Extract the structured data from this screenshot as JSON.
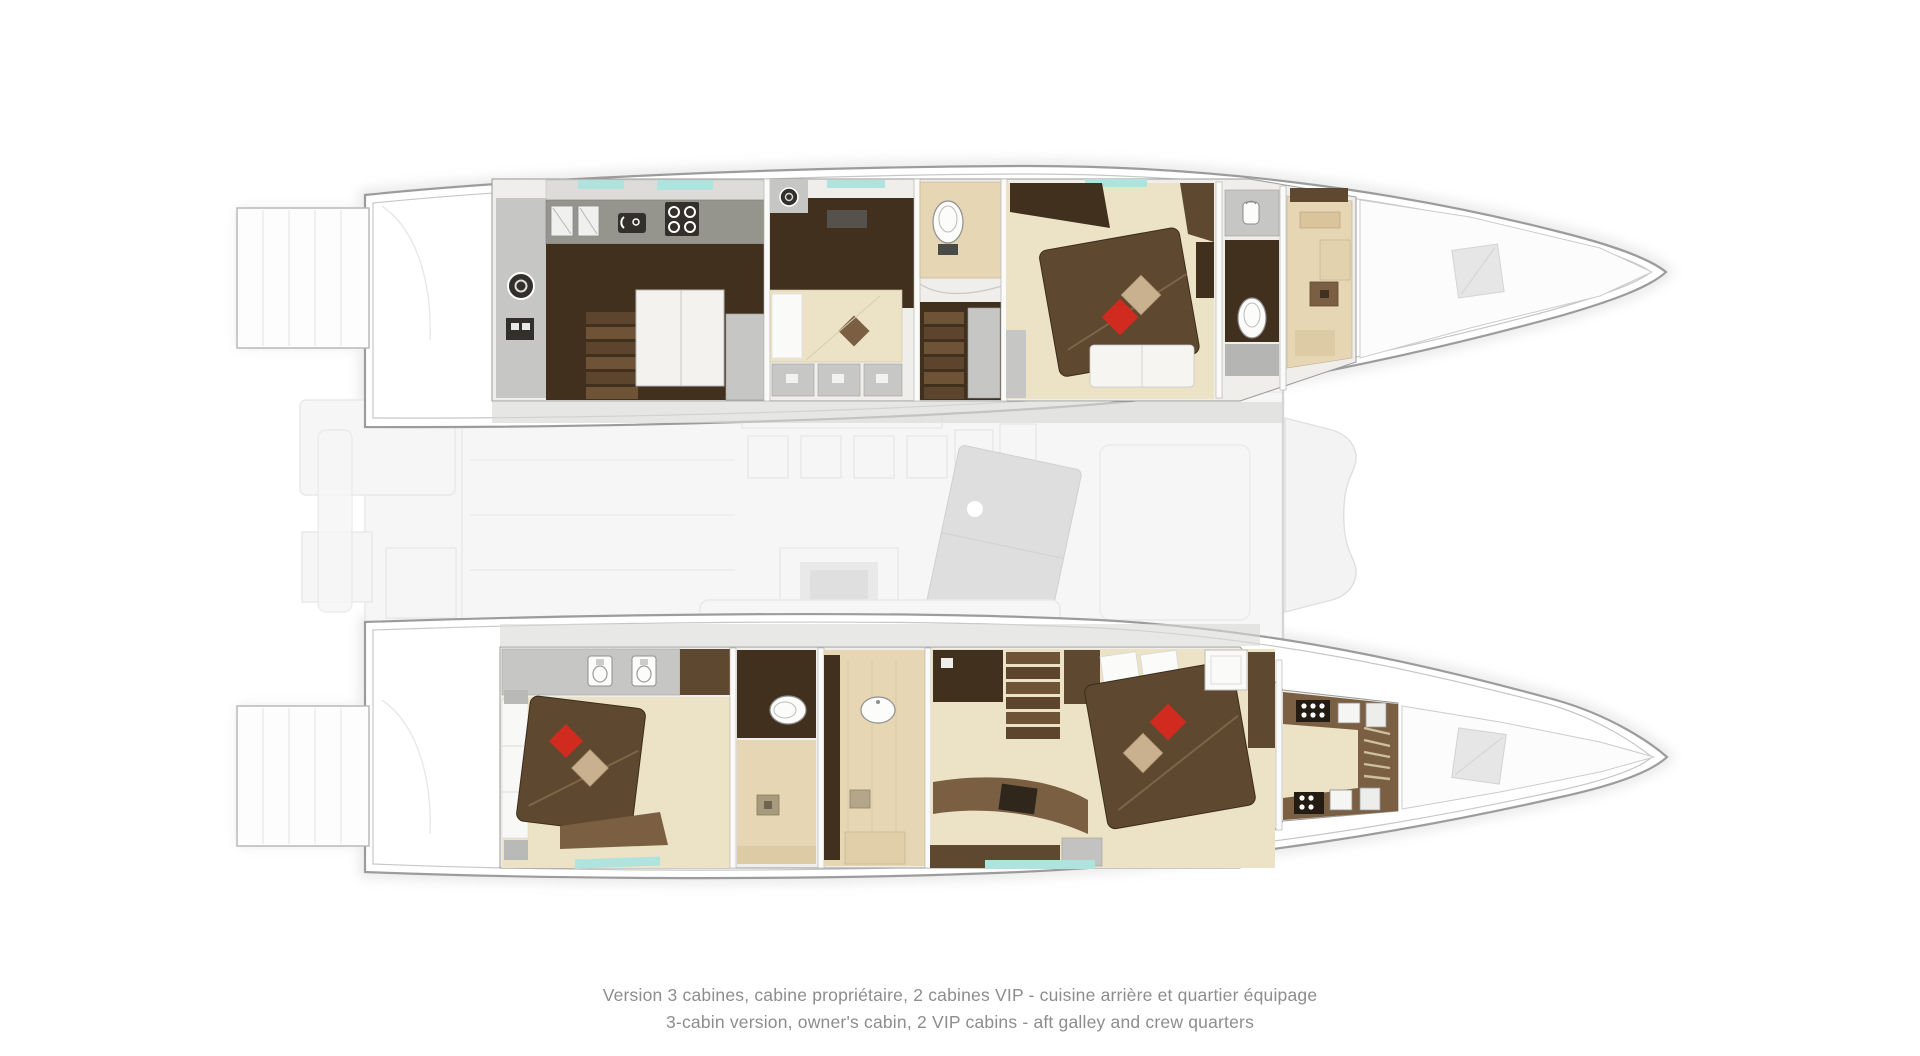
{
  "page": {
    "background": "#ffffff"
  },
  "caption": {
    "line_fr": "Version 3 cabines, cabine propriétaire, 2 cabines VIP - cuisine arrière et quartier équipage",
    "line_en": "3-cabin version, owner's cabin, 2 VIP cabins - aft galley and crew quarters",
    "color": "#8d8d8d"
  },
  "colors": {
    "hull-stroke": "#9c9c9c",
    "hull-inner-line": "#c7c7c7",
    "hull-shadow": "#d6d6d6",
    "deck-gray": "#d8d8d6",
    "wall-light": "#efeeea",
    "counter-gray": "#95958d",
    "cabinet-gray": "#c6c6c4",
    "wood-dark": "#42301f",
    "wood-mid": "#5f4830",
    "wood-warm": "#7b5f42",
    "floor-cream": "#ece2c6",
    "floor-beige": "#e7d6b4",
    "tan-cabinet": "#d9c49c",
    "teal-window": "#aee3de",
    "pillow-red": "#d02b1e",
    "pillow-tan": "#c9b18f",
    "appliance-dark": "#33302c",
    "fixture-white": "#fcfcfb",
    "faint-fill": "#f6f6f6",
    "faint-stroke": "#e8e8e8",
    "island-gray": "#dedede",
    "caption-gray": "#8d8d8d"
  },
  "icons": [
    "washing-machine-icon",
    "electrical-panel-icon",
    "sink-icon",
    "oven-icon",
    "cooktop-icon",
    "toilet-icon",
    "shower-drain-icon",
    "water-jug-icon",
    "stove-burners-icon",
    "bow-hatch-icon",
    "stairs-icon"
  ]
}
